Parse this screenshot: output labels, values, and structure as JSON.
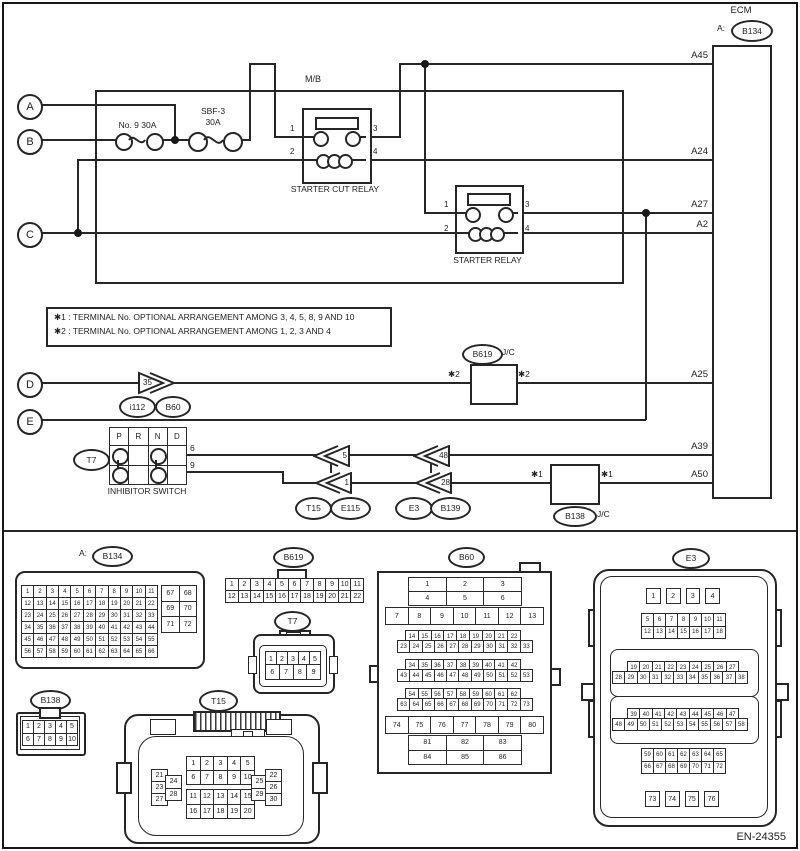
{
  "diagram_code": "EN-24355",
  "schematic": {
    "ecm": {
      "title": "ECM",
      "connector_prefix": "A:",
      "connector": "B134",
      "pins": {
        "a45": "A45",
        "a24": "A24",
        "a27": "A27",
        "a2": "A2",
        "a25": "A25",
        "a39": "A39",
        "a50": "A50"
      }
    },
    "mb": "M/B",
    "fuse1": {
      "label": "No. 9  30A"
    },
    "fuse2": {
      "line1": "SBF-3",
      "line2": "30A"
    },
    "relay1": {
      "name": "STARTER CUT RELAY"
    },
    "relay2": {
      "name": "STARTER RELAY"
    },
    "relay_terminals": {
      "t1": "1",
      "t2": "2",
      "t3": "3",
      "t4": "4"
    },
    "notes": {
      "line1": "✱1 : TERMINAL No. OPTIONAL ARRANGEMENT AMONG 3, 4, 5, 8, 9 AND 10",
      "line2": "✱2 : TERMINAL No. OPTIONAL ARRANGEMENT AMONG 1, 2, 3 AND 4"
    },
    "rings": {
      "a": "A",
      "b": "B",
      "c": "C",
      "d": "D",
      "e": "E"
    },
    "terminals": {
      "c35": "35",
      "c5": "5",
      "c1": "1",
      "c48": "48",
      "c28": "28",
      "t6": "6",
      "t9": "9"
    },
    "ovals": {
      "i112": "i112",
      "b60": "B60",
      "b619": "B619",
      "t7": "T7",
      "t15": "T15",
      "e115": "E115",
      "e3": "E3",
      "b139": "B139",
      "b138": "B138"
    },
    "jc": "J/C",
    "star1": "✱1",
    "star2": "✱2",
    "inhibitor": {
      "name": "INHIBITOR SWITCH",
      "header": {
        "cols": 4,
        "cells": [
          "P",
          "R",
          "N",
          "D"
        ]
      },
      "body": {
        "cols": 4,
        "cells": [
          "",
          "",
          "",
          "",
          "",
          "",
          "",
          ""
        ]
      }
    }
  },
  "pinouts": {
    "b134": {
      "title_prefix": "A:",
      "title": "B134",
      "main": {
        "cols": 11,
        "cells": [
          1,
          2,
          3,
          4,
          5,
          6,
          7,
          8,
          9,
          10,
          11,
          12,
          13,
          14,
          15,
          16,
          17,
          18,
          19,
          20,
          21,
          22,
          23,
          24,
          25,
          26,
          27,
          28,
          29,
          30,
          31,
          32,
          33,
          34,
          35,
          36,
          37,
          38,
          39,
          40,
          41,
          42,
          43,
          44,
          45,
          46,
          47,
          48,
          49,
          50,
          51,
          52,
          53,
          54,
          55,
          56,
          57,
          58,
          59,
          60,
          61,
          62,
          63,
          64,
          65,
          66
        ]
      },
      "side": {
        "cols": 2,
        "cells": [
          67,
          68,
          69,
          70,
          71,
          72
        ]
      }
    },
    "b619": {
      "title": "B619",
      "grid": {
        "cols": 11,
        "cells": [
          1,
          2,
          3,
          4,
          5,
          6,
          7,
          8,
          9,
          10,
          11,
          12,
          13,
          14,
          15,
          16,
          17,
          18,
          19,
          20,
          21,
          22
        ]
      }
    },
    "t7": {
      "title": "T7",
      "row1": {
        "cols": 5,
        "cells": [
          1,
          2,
          3,
          4,
          5
        ]
      },
      "row2": {
        "cols": 4,
        "cells": [
          6,
          7,
          8,
          9
        ]
      }
    },
    "b138": {
      "title": "B138",
      "grid": {
        "cols": 5,
        "cells": [
          1,
          2,
          3,
          4,
          5,
          6,
          7,
          8,
          9,
          10
        ]
      }
    },
    "t15": {
      "title": "T15",
      "top": {
        "cols": 5,
        "cells": [
          1,
          2,
          3,
          4,
          5,
          6,
          7,
          8,
          9,
          10
        ]
      },
      "bottom": {
        "cols": 5,
        "cells": [
          11,
          12,
          13,
          14,
          15,
          16,
          17,
          18,
          19,
          20
        ]
      },
      "left_a": {
        "cols": 1,
        "cells": [
          21,
          23,
          27
        ]
      },
      "left_b": {
        "cols": 1,
        "cells": [
          24,
          28
        ]
      },
      "right_a": {
        "cols": 1,
        "cells": [
          25,
          29
        ]
      },
      "right_b": {
        "cols": 1,
        "cells": [
          22,
          26,
          30
        ]
      }
    },
    "b60": {
      "title": "B60",
      "g1": {
        "cols": 3,
        "cells": [
          1,
          2,
          3,
          4,
          5,
          6
        ]
      },
      "g2": {
        "cols": 7,
        "cells": [
          7,
          8,
          9,
          10,
          11,
          12,
          13
        ]
      },
      "g3": {
        "cols": 9,
        "cells": [
          14,
          15,
          16,
          17,
          18,
          19,
          20,
          21,
          22
        ]
      },
      "g4": {
        "cols": 11,
        "cells": [
          23,
          24,
          25,
          26,
          27,
          28,
          29,
          30,
          31,
          32,
          33
        ]
      },
      "g5": {
        "cols": 9,
        "cells": [
          34,
          35,
          36,
          37,
          38,
          39,
          40,
          41,
          42
        ]
      },
      "g6": {
        "cols": 11,
        "cells": [
          43,
          44,
          45,
          46,
          47,
          48,
          49,
          50,
          51,
          52,
          53
        ]
      },
      "g7": {
        "cols": 9,
        "cells": [
          54,
          55,
          56,
          57,
          58,
          59,
          60,
          61,
          62
        ]
      },
      "g8": {
        "cols": 11,
        "cells": [
          63,
          64,
          65,
          66,
          67,
          68,
          69,
          70,
          71,
          72,
          73
        ]
      },
      "g9": {
        "cols": 7,
        "cells": [
          74,
          75,
          76,
          77,
          78,
          79,
          80
        ]
      },
      "g10": {
        "cols": 3,
        "cells": [
          81,
          82,
          83,
          84,
          85,
          86
        ]
      }
    },
    "e3": {
      "title": "E3",
      "top4": {
        "cols": 4,
        "cells": [
          1,
          2,
          3,
          4
        ]
      },
      "gA": {
        "cols": 7,
        "cells": [
          5,
          6,
          7,
          8,
          9,
          10,
          11,
          12,
          13,
          14,
          15,
          16,
          17,
          18
        ]
      },
      "gB1": {
        "cols": 9,
        "cells": [
          19,
          20,
          21,
          22,
          23,
          24,
          25,
          26,
          27
        ]
      },
      "gB2": {
        "cols": 11,
        "cells": [
          28,
          29,
          30,
          31,
          32,
          33,
          34,
          35,
          36,
          37,
          38
        ]
      },
      "gC1": {
        "cols": 9,
        "cells": [
          39,
          40,
          41,
          42,
          43,
          44,
          45,
          46,
          47
        ]
      },
      "gC2": {
        "cols": 11,
        "cells": [
          48,
          49,
          50,
          51,
          52,
          53,
          54,
          55,
          56,
          57,
          58
        ]
      },
      "gD": {
        "cols": 7,
        "cells": [
          59,
          60,
          61,
          62,
          63,
          64,
          65,
          66,
          67,
          68,
          69,
          70,
          71,
          72
        ]
      },
      "bot4": {
        "cols": 4,
        "cells": [
          73,
          74,
          75,
          76
        ]
      }
    }
  }
}
